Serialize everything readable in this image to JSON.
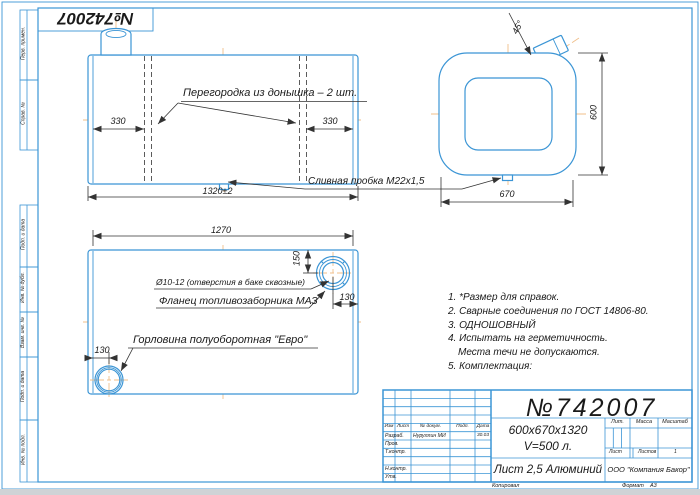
{
  "colors": {
    "line_blue": "#3b95d5",
    "centerline_orange": "#f0bf8a",
    "ink": "#1a1a1a"
  },
  "stamp": {
    "number_flipped": "№742007"
  },
  "top_view": {
    "partition_label": "Перегородка из донышка – 2 шт.",
    "dim_left": "330",
    "dim_right": "330",
    "dim_total": "1320±2",
    "drain_label": "Сливная пробка М22х1,5"
  },
  "end_view": {
    "neck_angle": "45°",
    "dim_height": "600",
    "dim_width": "670"
  },
  "side_view": {
    "dim_length": "1270",
    "holes_label": "Ø10-12 (отверстия в баке сквозные)",
    "flange_label": "Фланец топливозаборника МАЗ",
    "neck_label": "Горловина полуоборотная \"Евро\"",
    "dim_depth": "150",
    "dim_offset_right": "130",
    "dim_offset_left": "130"
  },
  "notes": [
    "1. *Размер для справок.",
    "2. Сварные соединения по ГОСТ 14806-80.",
    "3. ОДНОШОВНЫЙ",
    "4. Испытать на герметичность.",
    "Места течи не допускаются.",
    "5. Комплектация:"
  ],
  "margin_fields": [
    "Перв. примен.",
    "Справ. №",
    "Подп. и дата",
    "Инв. № дубл.",
    "Взам. инв. №",
    "Подп. и дата",
    "Инв. № подл."
  ],
  "title_block": {
    "doc_number": "№742007",
    "size": "600х670х1320",
    "volume": "V=500 л.",
    "material": "Лист 2,5 Алюминий",
    "company": "ООО \"Компания Бакор\"",
    "lit_label": "Лит.",
    "mass_label": "Масса",
    "scale_label": "Масштаб",
    "sheet_label": "Лист",
    "sheets_label": "Листов",
    "sheets_value": "1",
    "header_cols": [
      "Изм",
      "Лист",
      "№ докум.",
      "Подп.",
      "Дата"
    ],
    "rows": [
      "Разраб.",
      "Пров.",
      "Т.контр.",
      "Н.контр.",
      "Утв."
    ],
    "developer_name": "Нуруллин МИ",
    "developer_date": "30.03",
    "copied_label": "Копировал",
    "format_label": "Формат",
    "format_value": "А3"
  }
}
